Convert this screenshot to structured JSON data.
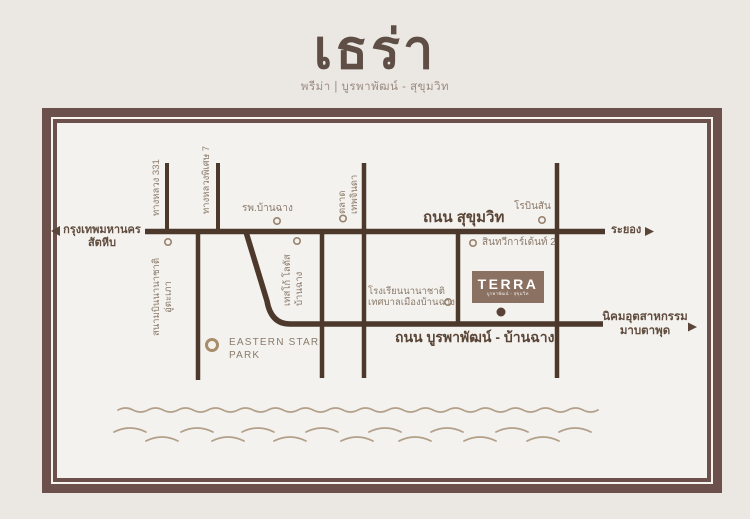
{
  "page": {
    "title": "เธร่า",
    "subtitle": "พรีม่า | บูรพาพัฒน์ - สุขุมวิท"
  },
  "map": {
    "roads": {
      "sukhumvit": "ถนน สุขุมวิท",
      "burapha": "ถนน บูรพาพัฒน์ - บ้านฉาง",
      "highway331": "ทางหลวง 331",
      "motorway7": "ทางหลวงพิเศษ 7"
    },
    "directions": {
      "bangkok_line1": "กรุงเทพมหานคร",
      "bangkok_line2": "สัตหีบ",
      "rayong": "ระยอง",
      "maptaphut_line1": "นิคมอุตสาหกรรม",
      "maptaphut_line2": "มาบตาพุด"
    },
    "places": {
      "airport_line1": "สนามบินนานาชาติ",
      "airport_line2": "อู่ตะเภา",
      "hospital": "รพ.บ้านฉาง",
      "tesco_line1": "เทสโก้ โลตัส",
      "tesco_line2": "บ้านฉาง",
      "market_line1": "ตลาด",
      "market_line2": "เทพจินดา",
      "robinson": "โรบินสัน",
      "sinthavee": "สินทวีการ์เด้นท์ 2",
      "school_line1": "โรงเรียนนานาชาติ",
      "school_line2": "เทศบาลเมืองบ้านฉาง",
      "park_line1": "EASTERN STAR",
      "park_line2": "PARK"
    },
    "project": {
      "name": "TERRA",
      "tagline": "บูรพาพัฒน์ - สุขุมวิท"
    }
  },
  "colors": {
    "frame": "#6b504b",
    "road": "#4c392c",
    "label": "#8a7a6b",
    "label_strong": "#5f4c3e",
    "wave": "#b3a08a",
    "project_box": "#8a7161",
    "marker_dot": "#5a4336",
    "page_bg": "#ebe8e3",
    "map_bg": "#f4f2ee"
  }
}
